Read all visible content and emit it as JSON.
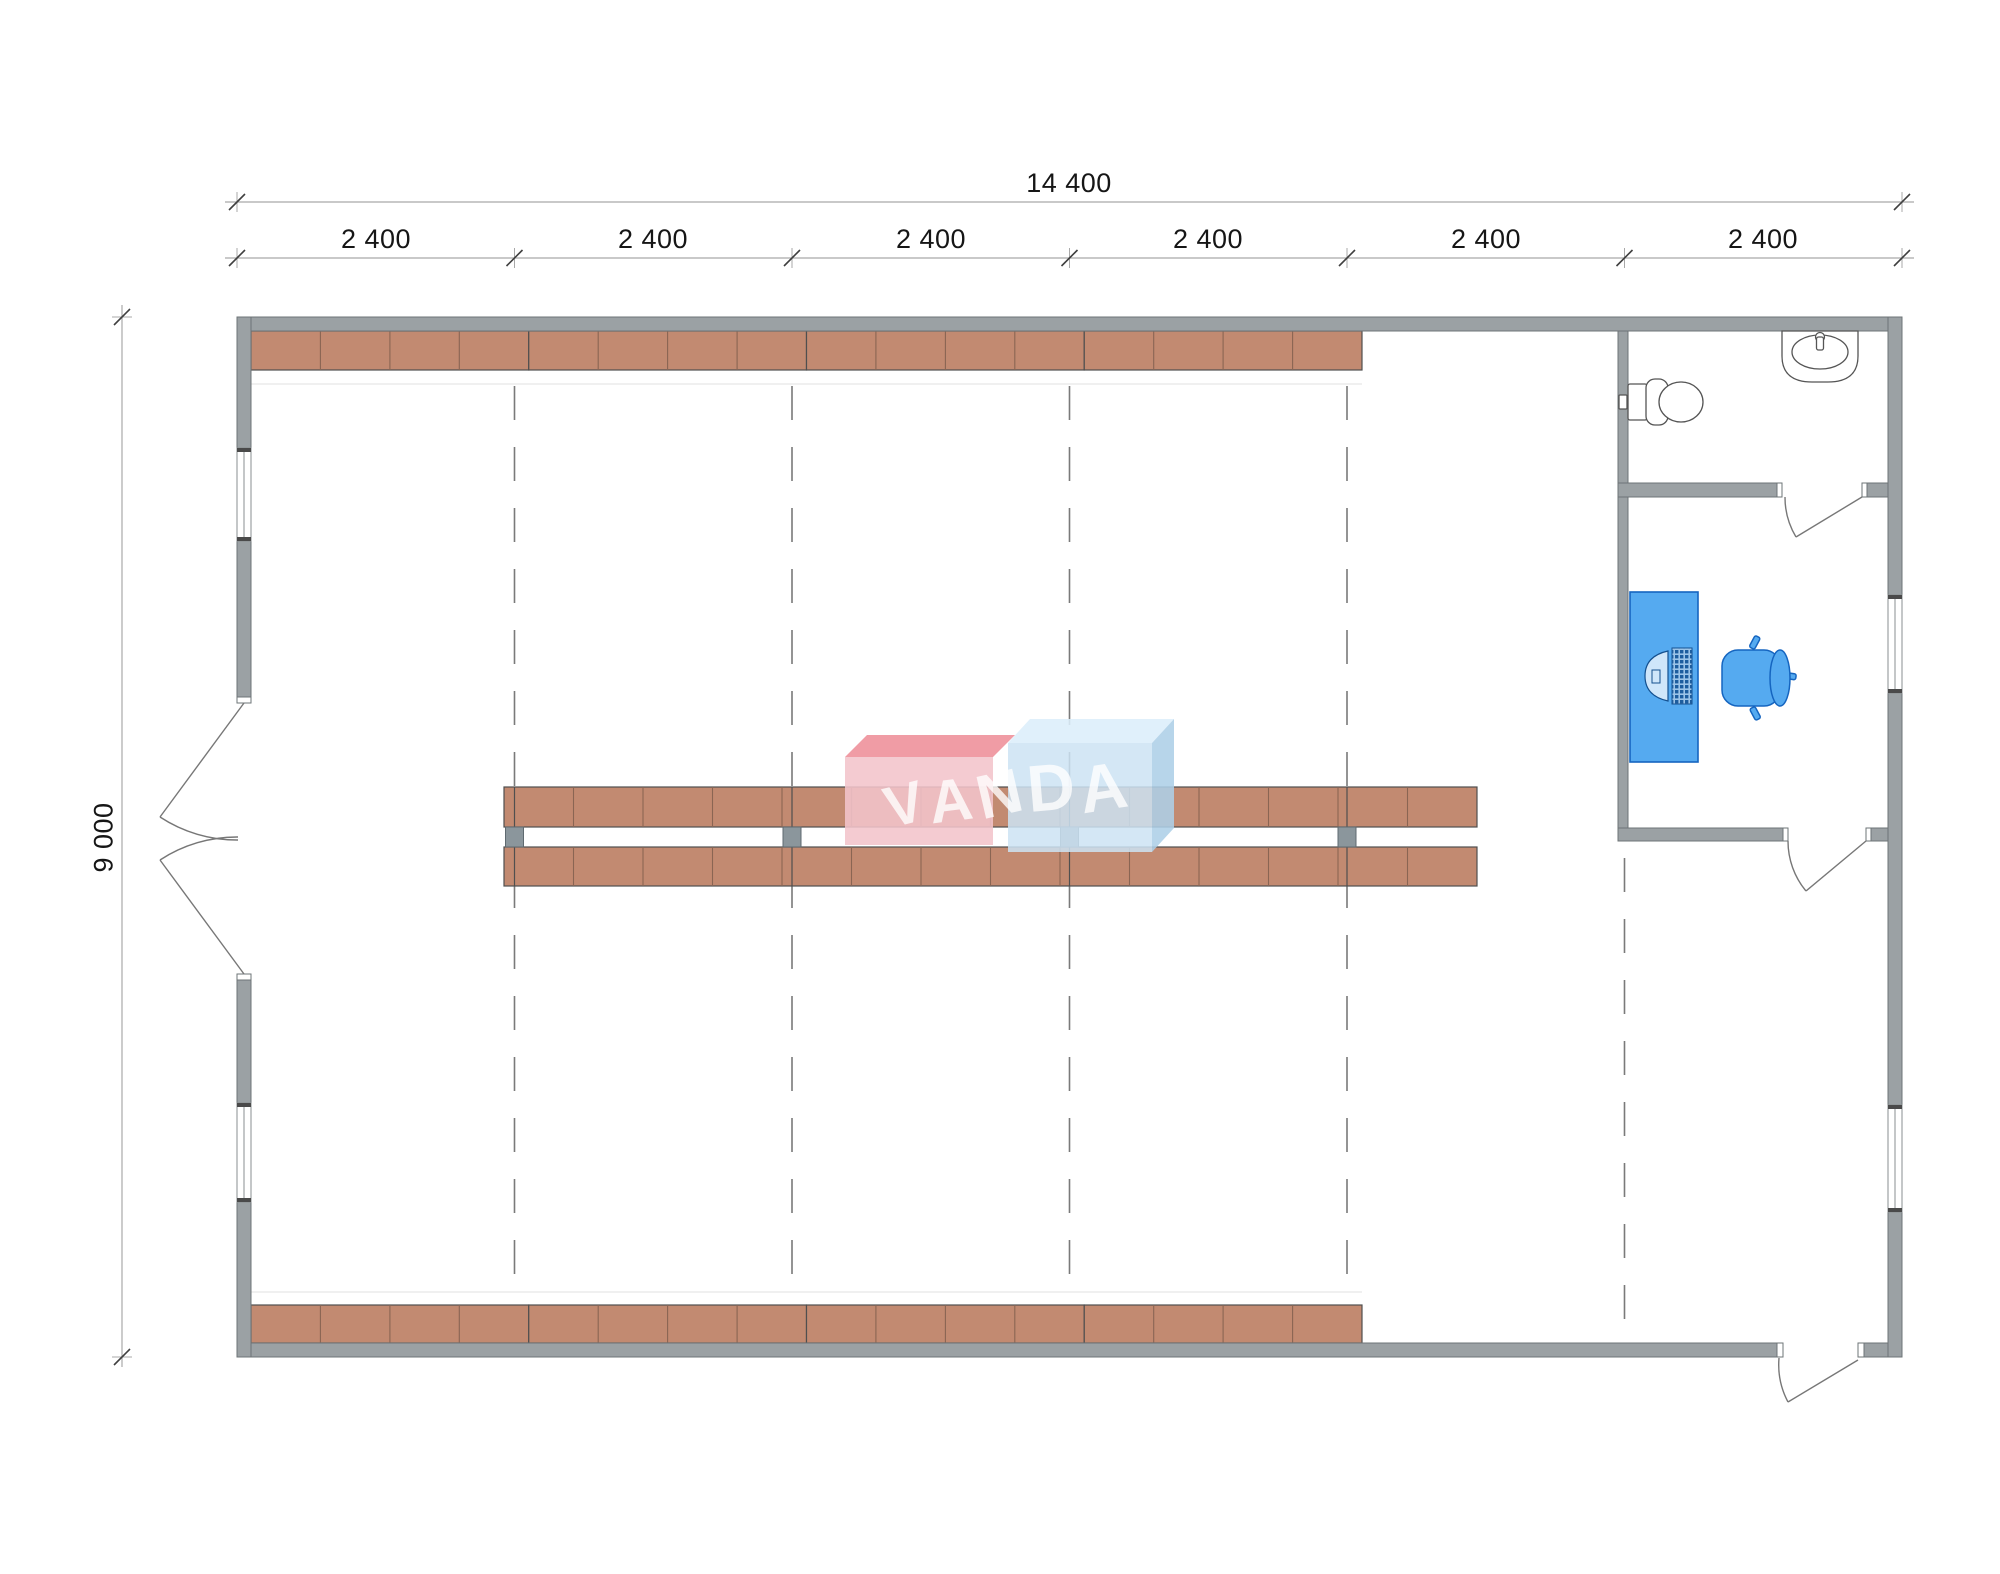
{
  "dimensions": {
    "total_width": "14 400",
    "height": "9 000",
    "bays": [
      "2 400",
      "2 400",
      "2 400",
      "2 400",
      "2 400",
      "2 400"
    ]
  },
  "watermark": {
    "text": "VANDA",
    "letters": [
      "V",
      "A",
      "N",
      "D",
      "A"
    ]
  },
  "colors": {
    "wall_gray": "#9ba1a4",
    "wall_outline": "#6e7477",
    "shelf_fill": "#c28a71",
    "shelf_outline": "#4f4f4f",
    "shelf_divider": "#8a6553",
    "post_gray": "#8b969c",
    "furniture_blue": "#55aaf0",
    "furniture_blue_outline": "#1565c0",
    "grid_dash": "#7a7a7a",
    "dimension_line": "#a9a9a9",
    "dimension_text": "#161616",
    "watermark_pink_front": "#f3c4cb",
    "watermark_pink_top": "#ee8e99",
    "watermark_blue_front": "#cde3f3",
    "watermark_blue_top": "#dceefa",
    "watermark_blue_side": "#adcfe7"
  }
}
